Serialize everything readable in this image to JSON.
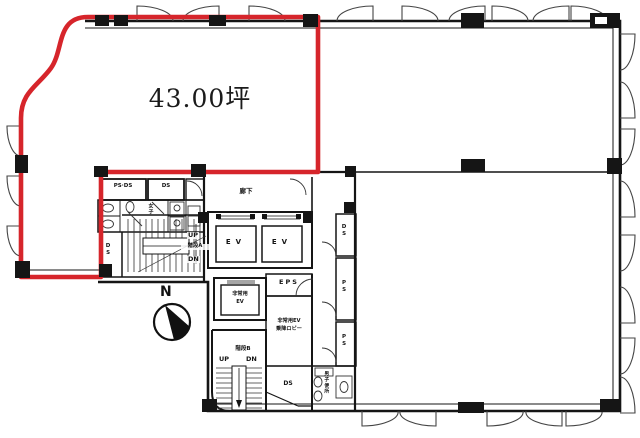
{
  "plan": {
    "area_label": "43.00坪",
    "compass_label": "N",
    "colors": {
      "highlight_red": "#d6252b",
      "wall_black": "#151515",
      "background": "#ffffff"
    },
    "labels": {
      "ps_ds": "PS·DS",
      "ds_top": "DS",
      "corridor": "廊下",
      "womens_wc": "女子",
      "ds_west": "DS",
      "stair_a": "階段A",
      "stair_a_up": "UP",
      "stair_a_dn": "DN",
      "ev_1": "EV",
      "ev_2": "EV",
      "ds_east": "DS",
      "ps_east_1": "PS",
      "ps_east_2": "PS",
      "emergency_ev_line1": "非常用",
      "emergency_ev_line2": "EV",
      "eps": "EPS",
      "ev_lobby_line1": "非常用EV",
      "ev_lobby_line2": "乗降ロビー",
      "stair_b": "階段B",
      "stair_b_up": "UP",
      "stair_b_dn": "DN",
      "ds_south": "DS",
      "mens_wc": "男子便所"
    }
  }
}
